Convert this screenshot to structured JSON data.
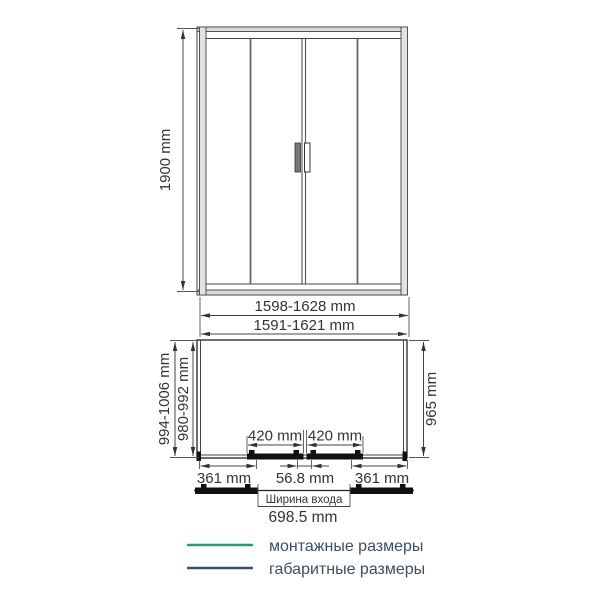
{
  "front_view": {
    "height": "1900 mm"
  },
  "plan_view": {
    "overall_width": "1598-1628 mm",
    "mounting_width": "1591-1621 mm",
    "overall_depth": "994-1006 mm",
    "mounting_depth": "980-992 mm",
    "side_depth": "965 mm",
    "door_panel_left": "420 mm",
    "door_panel_right": "420 mm",
    "side_panel_left": "361 mm",
    "center_overlap": "56.8 mm",
    "side_panel_right": "361 mm",
    "entrance_caption": "Ширина входа",
    "entrance_width": "698.5 mm"
  },
  "legend": {
    "items": [
      {
        "label": "монтажные размеры",
        "color": "#2f9b68"
      },
      {
        "label": "габаритные размеры",
        "color": "#3d5065"
      }
    ]
  },
  "colors": {
    "mounting_green": "#2f9b68",
    "overall_navy": "#3d5065",
    "line": "#444444"
  }
}
